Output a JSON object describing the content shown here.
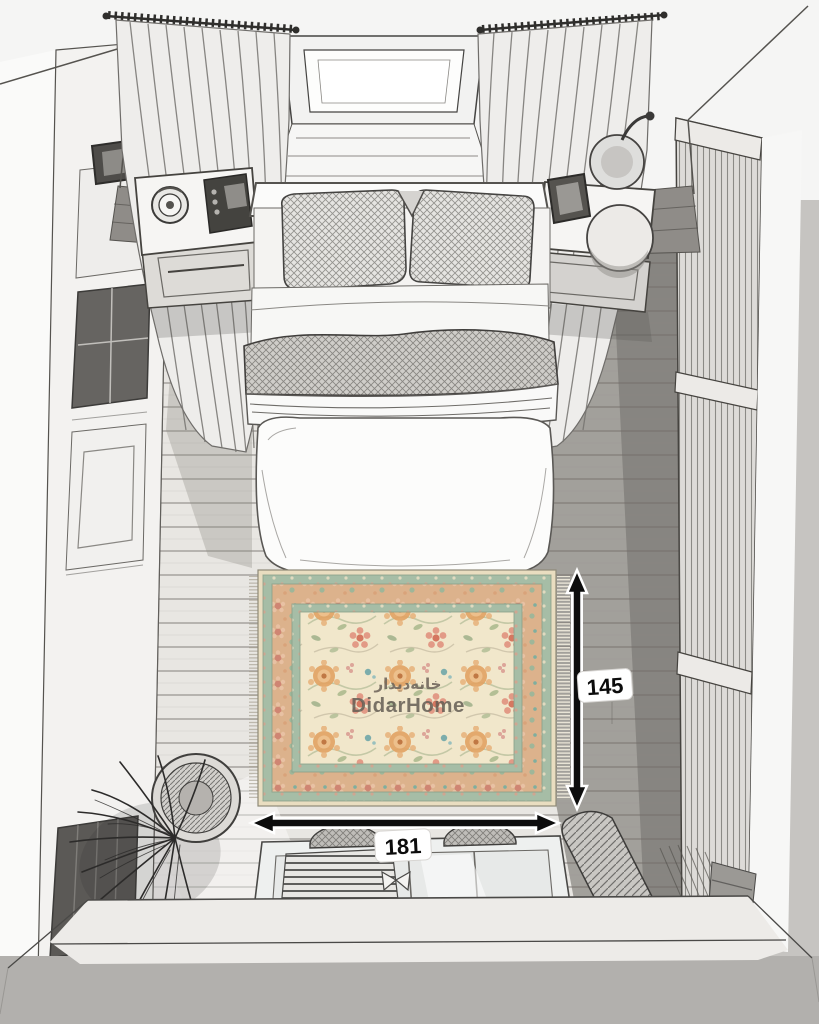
{
  "scene": {
    "type": "rug-size-visualization",
    "room": "bedroom-top-view-sketch"
  },
  "watermark": {
    "brand_fa": "خانه‌دیدار",
    "brand_en": "DidarHome"
  },
  "dimensions": {
    "rug_width_label": "181",
    "rug_height_label": "145"
  },
  "colors": {
    "rug_field": "#f1e7cb",
    "rug_border_green": "#a6bda6",
    "rug_border_tan": "#dcb28c",
    "rug_flower_orange": "#e2a263",
    "rug_flower_salmon": "#d57760",
    "rug_accent_teal": "#6fa7a9",
    "arrow": "#0d0d0d",
    "arrow_label_bg": "#ffffff",
    "floor_light": "#e8e6e2",
    "floor_dark": "#8d8a86",
    "sketch_line": "#4a4947",
    "bottom_band": "#b2b0ad"
  }
}
